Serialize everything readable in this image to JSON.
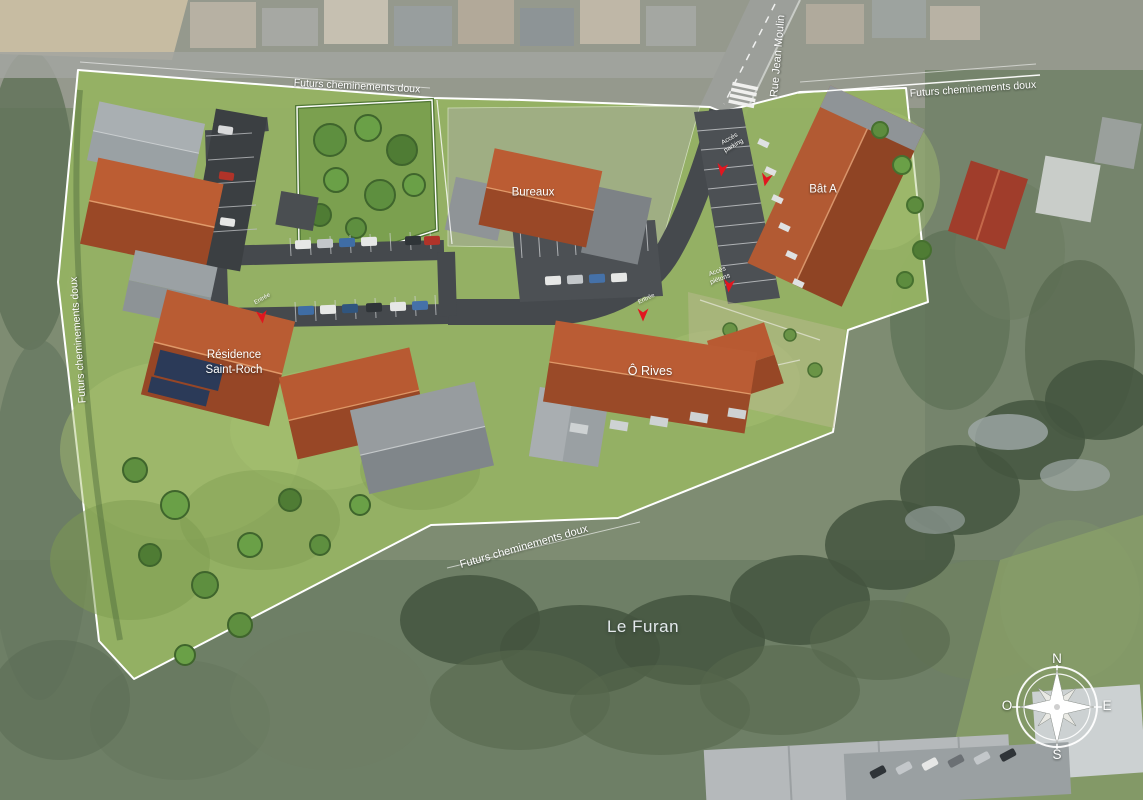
{
  "site_plan": {
    "path_labels": {
      "top_left": "Futurs cheminements doux",
      "top_right": "Futurs cheminements doux",
      "west": "Futurs cheminements doux",
      "south": "Futurs cheminements doux"
    },
    "street": "Rue Jean Moulin",
    "buildings": {
      "bureaux": "Bureaux",
      "bat_a": "Bât A",
      "residence_saint_roch": "Résidence\nSaint-Roch",
      "o_rives": "Ô Rives"
    },
    "access_labels": {
      "parking": "Accès\nparking",
      "pietons": "Accès\npiétons",
      "entree_residence": "Entrée",
      "entree_o_rives": "Entrée"
    },
    "river": "Le Furan",
    "compass": {
      "n": "N",
      "e": "E",
      "s": "S",
      "o": "O"
    },
    "colors": {
      "site_lawn": "#95b263",
      "roof_orange": "#b85a32",
      "roof_gray": "#8f9497",
      "road_dark": "#45494d",
      "boundary_white": "#ffffff",
      "arrow_red": "#e1161f",
      "label_white": "#ffffff"
    }
  }
}
